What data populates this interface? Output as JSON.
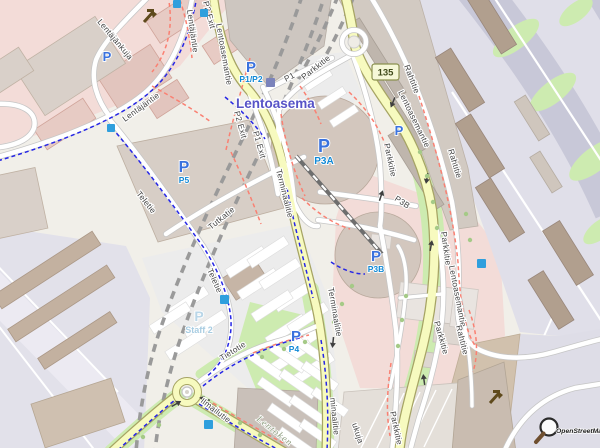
{
  "attribution": {
    "logo_text": "OpenStreetMap"
  },
  "route_badge": {
    "ref": "135"
  },
  "place_labels": {
    "airport": "Lentoasema",
    "area_fragment": "Lentoken"
  },
  "street_labels": {
    "lentoasemantie": "Lentoasemantie",
    "terminaalitie": "Terminaalitie",
    "terminaalitie_fragment": "minaalitie",
    "parkkitie": "Parkkitie",
    "rahtitie": "Rahtitie",
    "teletie": "Teletie",
    "tutkatie": "Tutkatie",
    "tietotie": "Tietotie",
    "ilmailutie": "Ilmailutie",
    "lentajantie": "Lentäjäntie",
    "lentajankuja": "Lentäjänkuja",
    "p1": "P1",
    "p2_exit": "P2 Exit",
    "p1_exit": "P1 Exit",
    "p3b_ramp": "P3B",
    "kuja_fragment": "ukuja"
  },
  "parking_labels": {
    "symbol": "P",
    "p1p2": "P1/P2",
    "p5": "P5",
    "p3a": "P3A",
    "p3b": "P3B",
    "p4": "P4",
    "staff2": "Staff 2"
  },
  "colors": {
    "road_secondary_fill": "#f7fabf",
    "road_secondary_casing": "#a6a464",
    "road_minor_fill": "#ffffff",
    "parking_icon_blue": "#3a72de",
    "parking_text_blue": "#1189d6",
    "airport_label_purple": "#5753c7",
    "footpath_red": "#fa8072",
    "cycleway_blue": "#2626e6",
    "grass_green": "#cdebb0",
    "apron_grey": "#e0dfe9",
    "building_grey": "#d9d0c9",
    "retail_pink": "#f3dcd8",
    "tunnel_grey": "#9a9a9a",
    "ref_badge_bg": "#f6f8d8"
  }
}
